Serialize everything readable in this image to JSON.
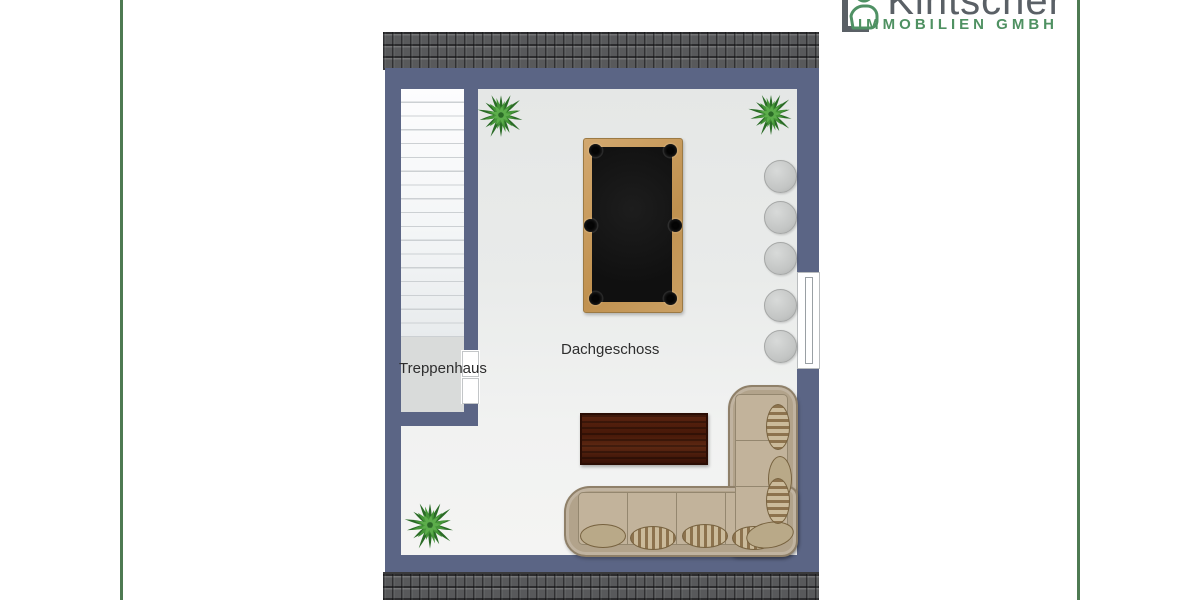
{
  "branding": {
    "company_name": "Kintscher",
    "company_subtitle": "IMMOBILIEN GMBH",
    "colors": {
      "name_gray": "#5a6066",
      "green": "#4f9162",
      "accent_line": "#4e7a52"
    }
  },
  "floorplan": {
    "floor_label": "Dachgeschoss",
    "stairwell_label": "Treppenhaus",
    "colors": {
      "wall": "#5b6585",
      "roof_tiles": "#58595b",
      "floor_main": "#edefee",
      "floor_stairwell": "#d9dbda",
      "stairs": "#f8f9fa",
      "window": "#ffffff",
      "pool_table_frame": "#c49a63",
      "pool_table_felt": "#141414",
      "coffee_table_wood": "#4c1c0b",
      "sofa_fabric": "#b2a38b",
      "stool_gray": "#c8cac9",
      "plant_green": "#3c8a33"
    },
    "furniture_icons": [
      "pool-table-icon",
      "l-shaped-sofa-icon",
      "coffee-table-icon",
      "stool-icon",
      "plant-icon",
      "window-icon",
      "door-icon",
      "staircase-icon"
    ]
  }
}
